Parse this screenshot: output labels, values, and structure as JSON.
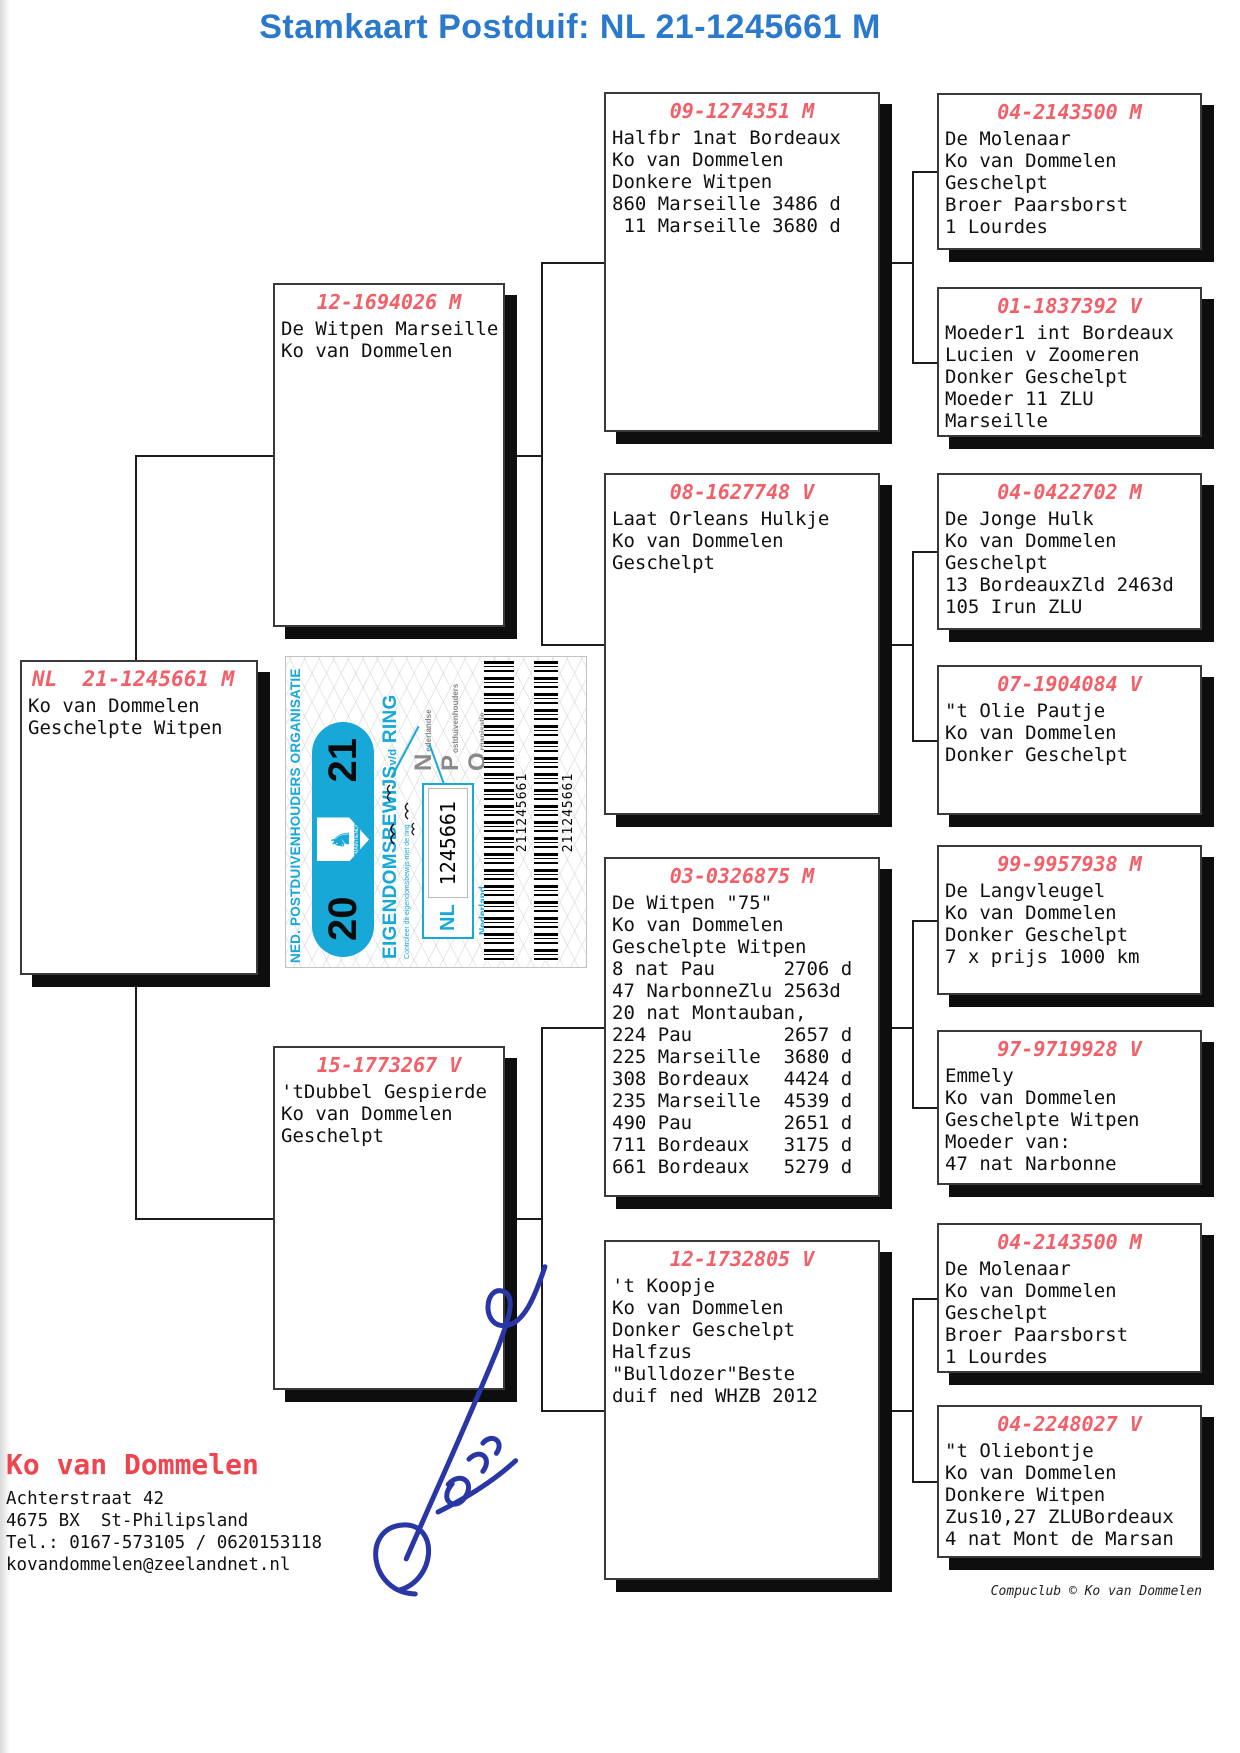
{
  "title": "Stamkaart Postduif: NL  21-1245661 M",
  "colors": {
    "title_blue": "#2a79cc",
    "ring_red": "#f25f68",
    "certificate_cyan": "#18a8d8",
    "owner_red": "#ef4550",
    "signature_blue": "#2836a6"
  },
  "pedigree": {
    "subject": {
      "ring": "NL  21-1245661 M",
      "lines": [
        "Ko van Dommelen",
        "Geschelpte Witpen"
      ]
    },
    "sire": {
      "ring": "12-1694026 M",
      "lines": [
        "De Witpen Marseille",
        "Ko van Dommelen"
      ]
    },
    "dam": {
      "ring": "15-1773267 V",
      "lines": [
        "'tDubbel Gespierde",
        "Ko van Dommelen",
        "Geschelpt"
      ]
    },
    "g09": {
      "ring": "09-1274351 M",
      "lines": [
        "Halfbr 1nat Bordeaux",
        "Ko van Dommelen",
        "Donkere Witpen",
        "860 Marseille 3486 d",
        " 11 Marseille 3680 d"
      ]
    },
    "g08": {
      "ring": "08-1627748 V",
      "lines": [
        "Laat Orleans Hulkje",
        "Ko van Dommelen",
        "Geschelpt"
      ]
    },
    "g03": {
      "ring": "03-0326875 M",
      "lines": [
        "De Witpen \"75\"",
        "Ko van Dommelen",
        "Geschelpte Witpen",
        "8 nat Pau      2706 d",
        "47 NarbonneZlu 2563d",
        "20 nat Montauban,",
        "224 Pau        2657 d",
        "225 Marseille  3680 d",
        "308 Bordeaux   4424 d",
        "235 Marseille  4539 d",
        "490 Pau        2651 d",
        "711 Bordeaux   3175 d",
        "661 Bordeaux   5279 d"
      ]
    },
    "g12": {
      "ring": "12-1732805 V",
      "lines": [
        "'t Koopje",
        "Ko van Dommelen",
        "Donker Geschelpt",
        "Halfzus",
        "\"Bulldozer\"Beste",
        "duif ned WHZB 2012"
      ]
    },
    "gg1": {
      "ring": "04-2143500 M",
      "lines": [
        "De Molenaar",
        "Ko van Dommelen",
        "Geschelpt",
        "Broer Paarsborst",
        "1 Lourdes"
      ]
    },
    "gg2": {
      "ring": "01-1837392 V",
      "lines": [
        "Moeder1 int Bordeaux",
        "Lucien v Zoomeren",
        "Donker Geschelpt",
        "Moeder 11 ZLU",
        "Marseille"
      ]
    },
    "gg3": {
      "ring": "04-0422702 M",
      "lines": [
        "De Jonge Hulk",
        "Ko van Dommelen",
        "Geschelpt",
        "13 BordeauxZld 2463d",
        "105 Irun ZLU"
      ]
    },
    "gg4": {
      "ring": "07-1904084 V",
      "lines": [
        "\"t Olie Pautje",
        "Ko van Dommelen",
        "Donker Geschelpt"
      ]
    },
    "gg5": {
      "ring": "99-9957938 M",
      "lines": [
        "De Langvleugel",
        "Ko van Dommelen",
        "Donker Geschelpt",
        "7 x prijs 1000 km"
      ]
    },
    "gg6": {
      "ring": "97-9719928 V",
      "lines": [
        "Emmely",
        "Ko van Dommelen",
        "Geschelpte Witpen",
        "Moeder van:",
        "47 nat Narbonne"
      ]
    },
    "gg7": {
      "ring": "04-2143500 M",
      "lines": [
        "De Molenaar",
        "Ko van Dommelen",
        "Geschelpt",
        "Broer Paarsborst",
        "1 Lourdes"
      ]
    },
    "gg8": {
      "ring": "04-2248027 V",
      "lines": [
        "\"t Oliebontje",
        "Ko van Dommelen",
        "Donkere Witpen",
        "Zus10,27 ZLUBordeaux",
        "4 nat Mont de Marsan"
      ]
    }
  },
  "certificate": {
    "org": "NED. POSTDUIVENHOUDERS ORGANISATIE",
    "year_left": "20",
    "year_right": "21",
    "motto": "JE MAINTIENDRAI",
    "title_main": "EIGENDOMSBEWIJS",
    "title_vd": "v/d",
    "title_end": "RING",
    "npo": [
      {
        "big": "N",
        "rest": "ederlandse"
      },
      {
        "big": "P",
        "rest": "ostduivenhouders"
      },
      {
        "big": "O",
        "rest": "rganisatie"
      }
    ],
    "country_code": "NL",
    "ring_number": "1245661",
    "country_label": "Nederland",
    "check_text": "Controleer dit eigendomsbewijs met de ring",
    "barcode_text": "211245661",
    "emblem_glyph": "♞"
  },
  "owner": {
    "name": "Ko van Dommelen",
    "address": [
      "Achterstraat 42",
      "4675 BX  St-Philipsland",
      "Tel.: 0167-573105 / 0620153118",
      "kovandommelen@zeelandnet.nl"
    ]
  },
  "footer": {
    "credit": "Compuclub © Ko van Dommelen"
  }
}
